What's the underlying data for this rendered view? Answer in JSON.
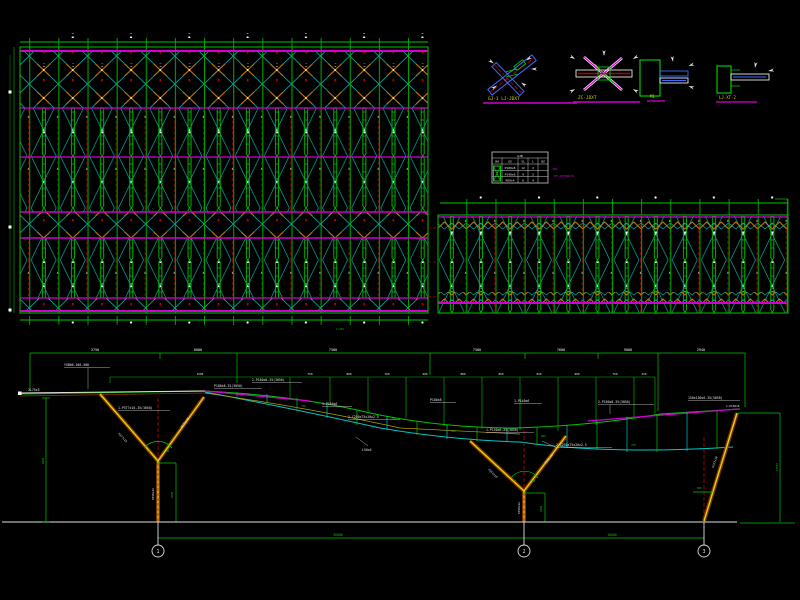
{
  "drawing": {
    "type": "structural-cad-sheet",
    "background": "#000000"
  },
  "palette": {
    "green": "#00c800",
    "dark_green": "#00a000",
    "magenta": "#d200d2",
    "cyan": "#00c8c8",
    "red": "#c80000",
    "orange": "#d27800",
    "yellow_title": "#d2d200",
    "white": "#e6e6e6",
    "ground_gray": "#b4b4b4",
    "column_brown": "#7a3200",
    "column_yellow": "#e6d200",
    "detail_blue": "#3c6cff"
  },
  "main_plan": {
    "note": "1:100"
  },
  "details": [
    {
      "title": "GJ-1 LJ-JDXT"
    },
    {
      "title": "ZC-JDXT"
    },
    {
      "title": "M1"
    },
    {
      "title": "LJ-XT-2"
    }
  ],
  "schedule_table": {
    "title": "GJB",
    "headers": [
      "BH",
      "GG",
      "SL",
      "L",
      "BZ"
    ],
    "rows": [
      [
        "P180x8",
        "12",
        "2",
        ""
      ],
      [
        "P140x6",
        "9",
        "2",
        ""
      ],
      [
        "P89x4",
        "6",
        "4",
        ""
      ]
    ]
  },
  "notes": {
    "line1": "JD2",
    "line2": "PM-XITONGTU"
  },
  "elevation": {
    "dims_row1": [
      "3750",
      "8000",
      "7500",
      "7500",
      "7600",
      "9000",
      "2940"
    ],
    "dims_row2": [
      "1500",
      "750",
      "800",
      "760",
      "900",
      "880",
      "850",
      "830",
      "900",
      "750",
      "420"
    ],
    "tie_tags": [
      "750",
      "750",
      "900",
      "900",
      "750"
    ],
    "left_height": "9000",
    "right_height": "10500",
    "col_spans": [
      "36000",
      "18000"
    ],
    "grid_bubbles": [
      "1",
      "2",
      "3"
    ],
    "angles": {
      "a1l": "60",
      "a1r": "60",
      "a2l": "60",
      "a2r": "60"
    },
    "v1_dim": "4500",
    "v2_dim": "2800",
    "incline_dim": "600",
    "arm_labels": [
      "P377x10",
      "P377x10",
      "P351x10",
      "P351x10"
    ],
    "stem_labels": [
      "P450x12",
      "P450x12"
    ],
    "incline_label": "P377x10",
    "labels": [
      {
        "t": "YXB66-166-500"
      },
      {
        "t": "2L75x5"
      },
      {
        "t": "P180x8-35(3050)"
      },
      {
        "t": "1-P150x6"
      },
      {
        "t": "2-C250x75x20x2.5"
      },
      {
        "t": "1-P140x6"
      },
      {
        "t": "2-P180x8-35(3050)"
      },
      {
        "t": "150x150x6-35(5050)"
      },
      {
        "t": "1-P150x6"
      },
      {
        "t": "2-C250x75x20x2.5"
      },
      {
        "t": "L50x4"
      },
      {
        "t": "P180x8"
      },
      {
        "t": "2-P180x8-35(3050)"
      },
      {
        "t": "1-P377x10-35(3050)"
      },
      {
        "t": "1-P150x6-35(3050)"
      }
    ]
  }
}
